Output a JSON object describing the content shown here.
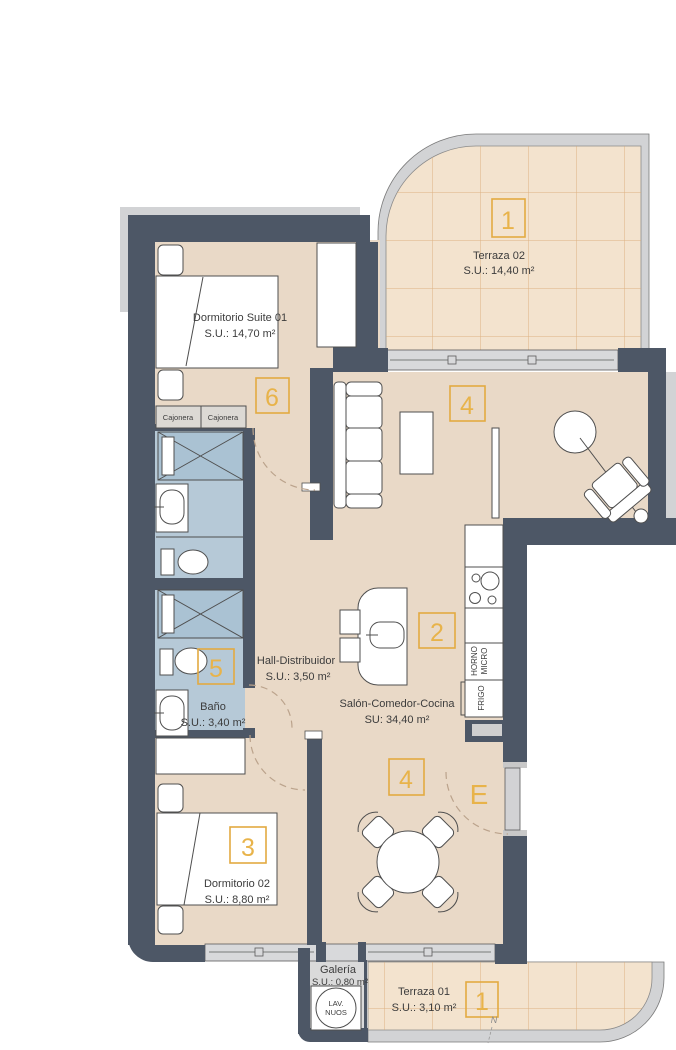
{
  "plan_title": "Apartment floor plan",
  "rooms": {
    "terraza02": {
      "name": "Terraza 02",
      "area": "S.U.: 14,40 m²",
      "tag": "1"
    },
    "suite": {
      "name": "Dormitorio Suite 01",
      "area": "S.U.: 14,70 m²",
      "tag": "6"
    },
    "hall": {
      "name": "Hall-Distribuidor",
      "area": "S.U.: 3,50 m²"
    },
    "bano": {
      "name": "Baño",
      "area": "S.U.: 3,40 m²",
      "tag": "5"
    },
    "salon": {
      "name": "Salón-Comedor-Cocina",
      "area": "SU: 34,40 m²",
      "tag_living": "4",
      "tag_kitchen": "2",
      "tag_dining": "4"
    },
    "dorm02": {
      "name": "Dormitorio 02",
      "area": "S.U.: 8,80 m²",
      "tag": "3"
    },
    "galeria": {
      "name": "Galería",
      "area": "S.U.: 0,80 m²"
    },
    "terraza01": {
      "name": "Terraza 01",
      "area": "S.U.: 3,10 m²",
      "tag": "1"
    },
    "entrance": {
      "tag": "E"
    }
  },
  "fixtures": {
    "cajonera_left": "Cajonera",
    "cajonera_right": "Cajonera",
    "horno_line1": "HORNO",
    "horno_line2": "MICRO",
    "frigo": "FRIGO",
    "lav_line1": "LAV.",
    "lav_line2": "NUOS"
  },
  "compass": {
    "north": "N"
  },
  "colors": {
    "wall": "#4d5766",
    "floor": "#e9d9c7",
    "terrace_floor": "#f3e3ce",
    "terrace_grid": "#d9a974",
    "bath_floor": "#b6c9d7",
    "galeria_floor": "#dadada",
    "window": "#d8d9db",
    "outer_band": "#d2d3d5",
    "accent_yellow": "#e3aa41",
    "text": "#3c3c3c"
  }
}
